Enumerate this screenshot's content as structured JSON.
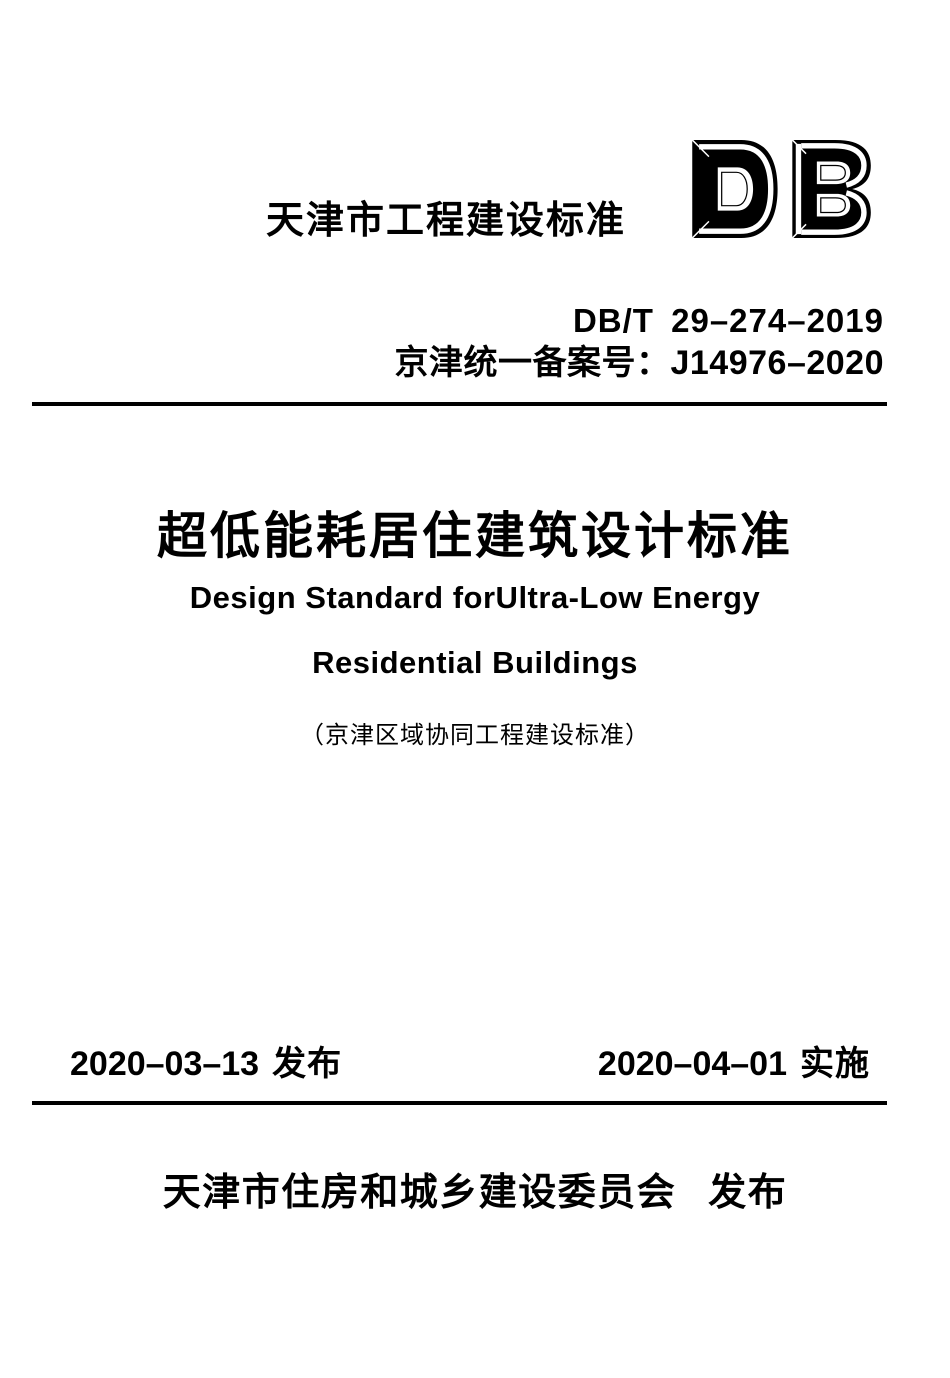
{
  "document": {
    "header": {
      "category_label": "天津市工程建设标准",
      "logo_text": "DB",
      "standard_code": "DB/T 29–274–2019",
      "filing_label": "京津统一备案号：J14976–2020"
    },
    "title": {
      "zh": "超低能耗居住建筑设计标准",
      "en_line1": "Design Standard forUltra-Low Energy",
      "en_line2": "Residential Buildings",
      "note": "（京津区域协同工程建设标准）"
    },
    "dates": {
      "issue_date": "2020–03–13",
      "issue_label": "发布",
      "effective_date": "2020–04–01",
      "effective_label": "实施"
    },
    "publisher": {
      "name": "天津市住房和城乡建设委员会",
      "action": "发布"
    },
    "colors": {
      "text": "#000000",
      "background": "#ffffff",
      "rule": "#000000"
    }
  }
}
